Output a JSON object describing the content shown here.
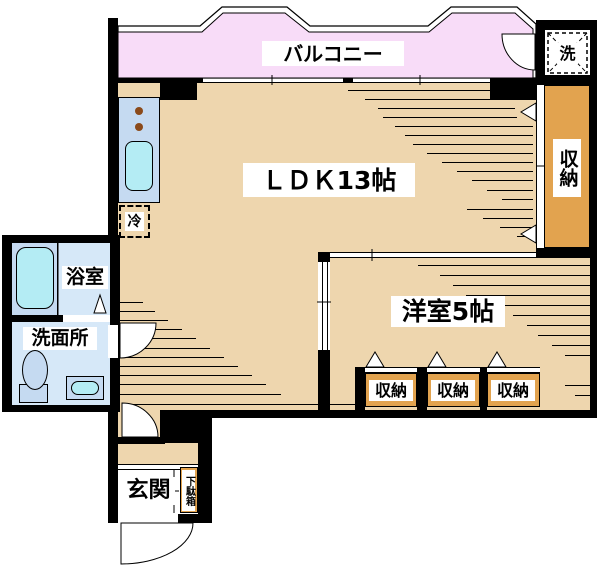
{
  "colors": {
    "floor_tan": "#eed6ae",
    "balcony_pink": "#f8dcf8",
    "closet_orange": "#e2a34f",
    "room_blue": "#d6e8f8",
    "fixture_blue": "#c5daf1",
    "water_cyan": "#b4ecf4",
    "burner_brown": "#8b4a1a",
    "wall_black": "#000000"
  },
  "floor_plan": {
    "balcony": {
      "label": "バルコニー"
    },
    "washer_space": {
      "label": "洗"
    },
    "ldk": {
      "label": "ＬＤＫ13帖"
    },
    "storage_right": {
      "label": "収納"
    },
    "fridge": {
      "label": "冷"
    },
    "western_room": {
      "label": "洋室5帖"
    },
    "closets": {
      "c1": "収納",
      "c2": "収納",
      "c3": "収納"
    },
    "bathroom": {
      "label": "浴室"
    },
    "washroom": {
      "label": "洗面所"
    },
    "entrance": {
      "label": "玄関"
    },
    "shoe_cabinet": {
      "label": "下駄箱"
    }
  }
}
